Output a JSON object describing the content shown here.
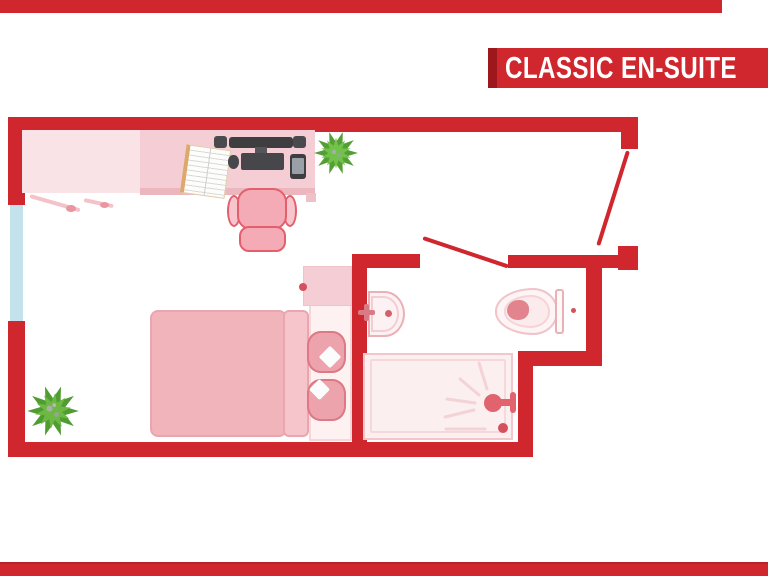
{
  "banner": {
    "title": "CLASSIC EN-SUITE"
  },
  "colors": {
    "wall_red": "#d0262e",
    "banner_red": "#d0262e",
    "banner_shadow_red": "#9c181d",
    "window_blue": "#c4e2eb",
    "desk_pink_light": "#fae3e6",
    "desk_pink": "#f5cdd4",
    "bed_blanket_pink": "#f1b4bb",
    "pillow_pink": "#eca3ac",
    "fixture_outline_pink": "#eab0b6",
    "accent_dot_red": "#d4505c",
    "plant_green": "#68b33c",
    "device_gray": "#3e3e41"
  },
  "floor_plan": {
    "rooms": [
      "bedroom",
      "en-suite-bathroom"
    ],
    "furniture_icons": [
      "desk",
      "desk-return",
      "monitor",
      "speakers",
      "keyboard",
      "mouse",
      "smartphone",
      "open-book",
      "office-chair",
      "desk-plant",
      "bed",
      "duvet-fold",
      "pillows",
      "bedside-table",
      "floor-plant",
      "window",
      "entry-door",
      "bathroom-door",
      "sink",
      "tap",
      "toilet",
      "toilet-cistern",
      "shower-tray",
      "shower-head",
      "drain"
    ]
  }
}
